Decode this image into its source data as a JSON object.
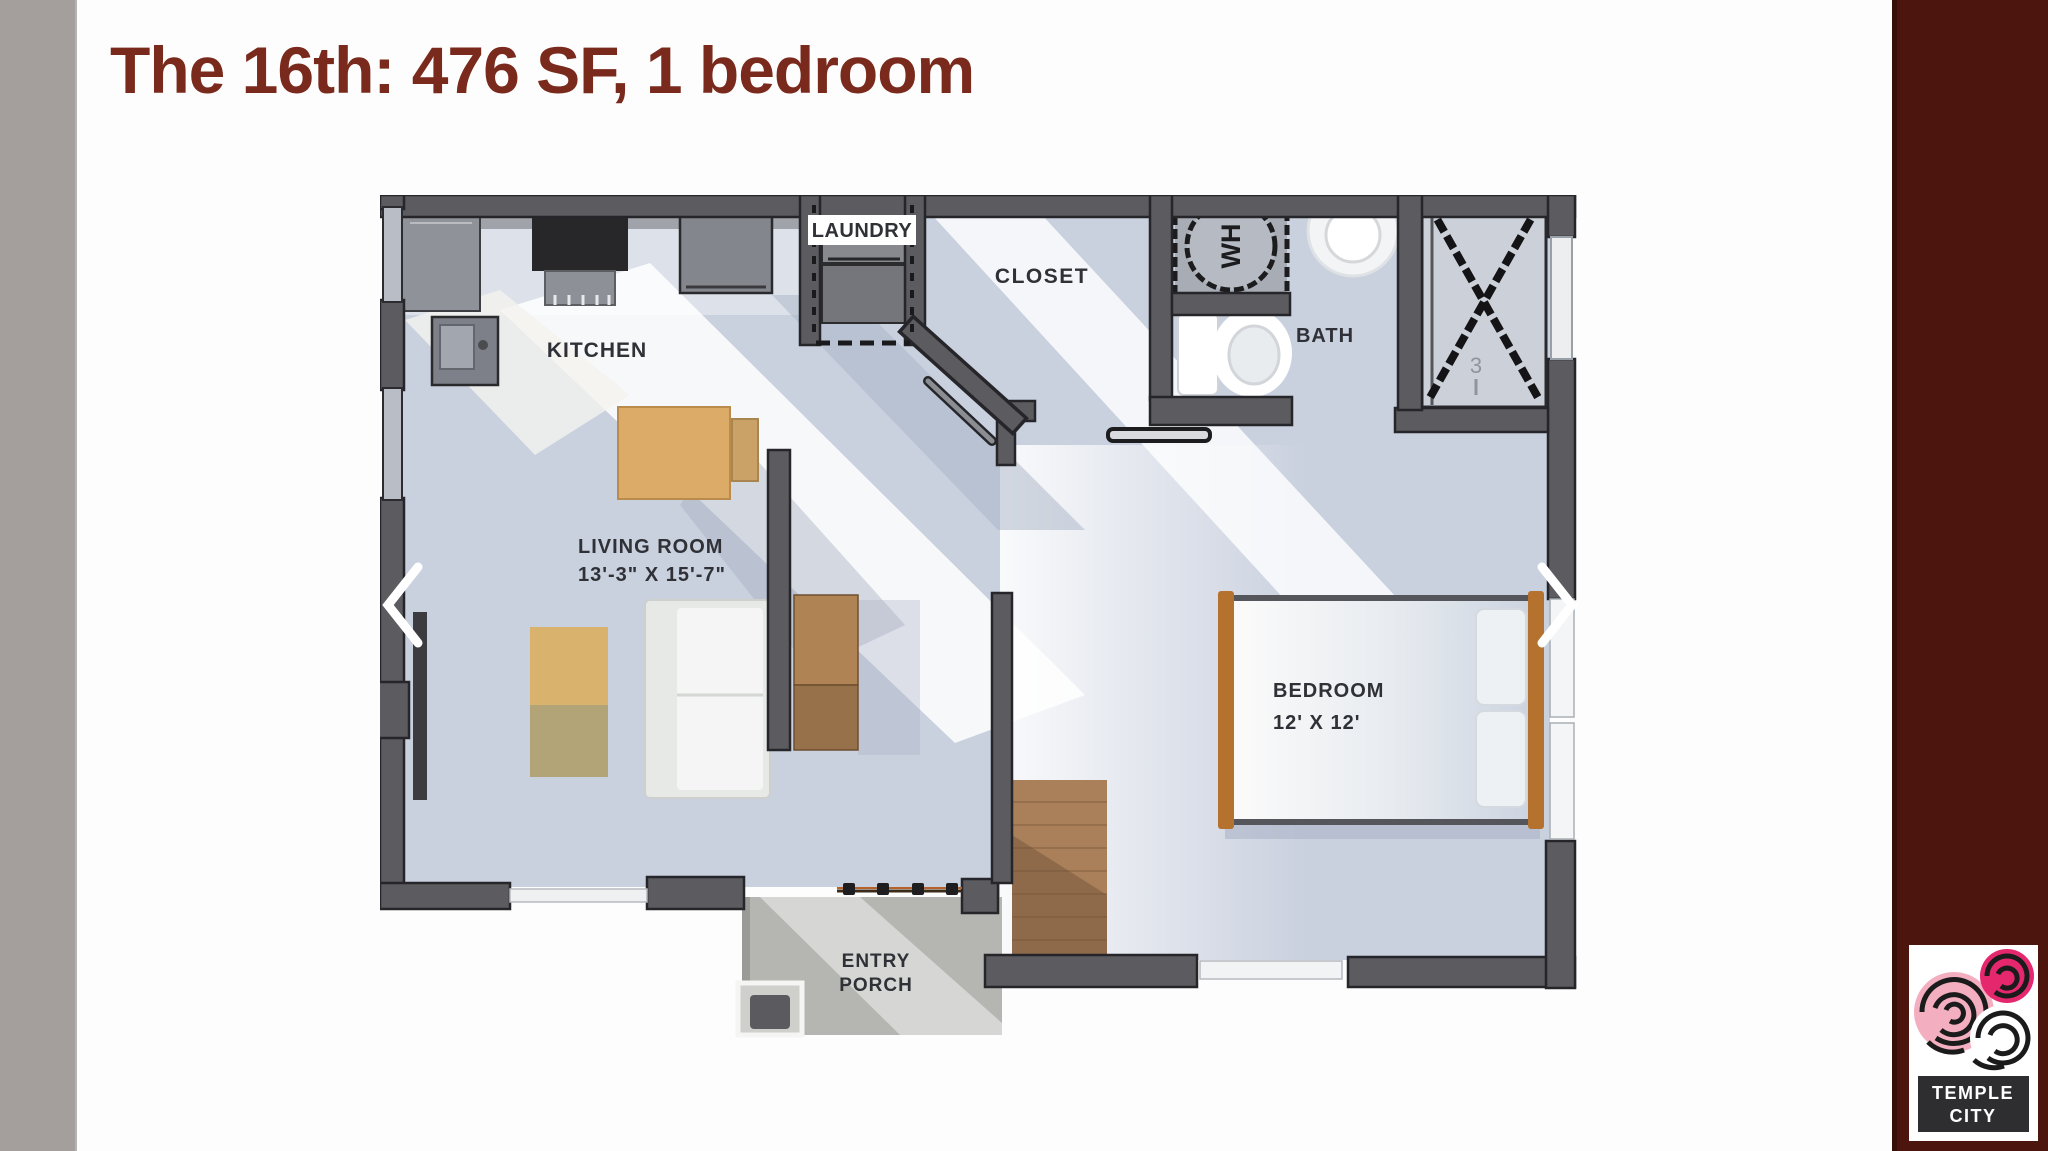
{
  "slide": {
    "title": "The 16th: 476 SF, 1 bedroom"
  },
  "floorplan": {
    "rooms": [
      {
        "id": "kitchen",
        "label": "KITCHEN"
      },
      {
        "id": "laundry",
        "label": "LAUNDRY"
      },
      {
        "id": "closet",
        "label": "CLOSET"
      },
      {
        "id": "bath",
        "label": "BATH"
      },
      {
        "id": "living_room",
        "label": "LIVING ROOM",
        "dimensions": "13'-3\" X 15'-7\""
      },
      {
        "id": "bedroom",
        "label": "BEDROOM",
        "dimensions": "12' X 12'"
      },
      {
        "id": "entry_porch",
        "label_line1": "ENTRY",
        "label_line2": "PORCH"
      }
    ],
    "fixtures": {
      "water_heater_label": "WH",
      "closet_mark": "3"
    }
  },
  "logo": {
    "line1": "TEMPLE",
    "line2": "CITY"
  },
  "colors": {
    "accent": "#7a2a1c",
    "left_bar": "#a49e9c",
    "right_bar": "#4c150e",
    "wall": "#5b5b60",
    "floor": "#c9d0de"
  }
}
